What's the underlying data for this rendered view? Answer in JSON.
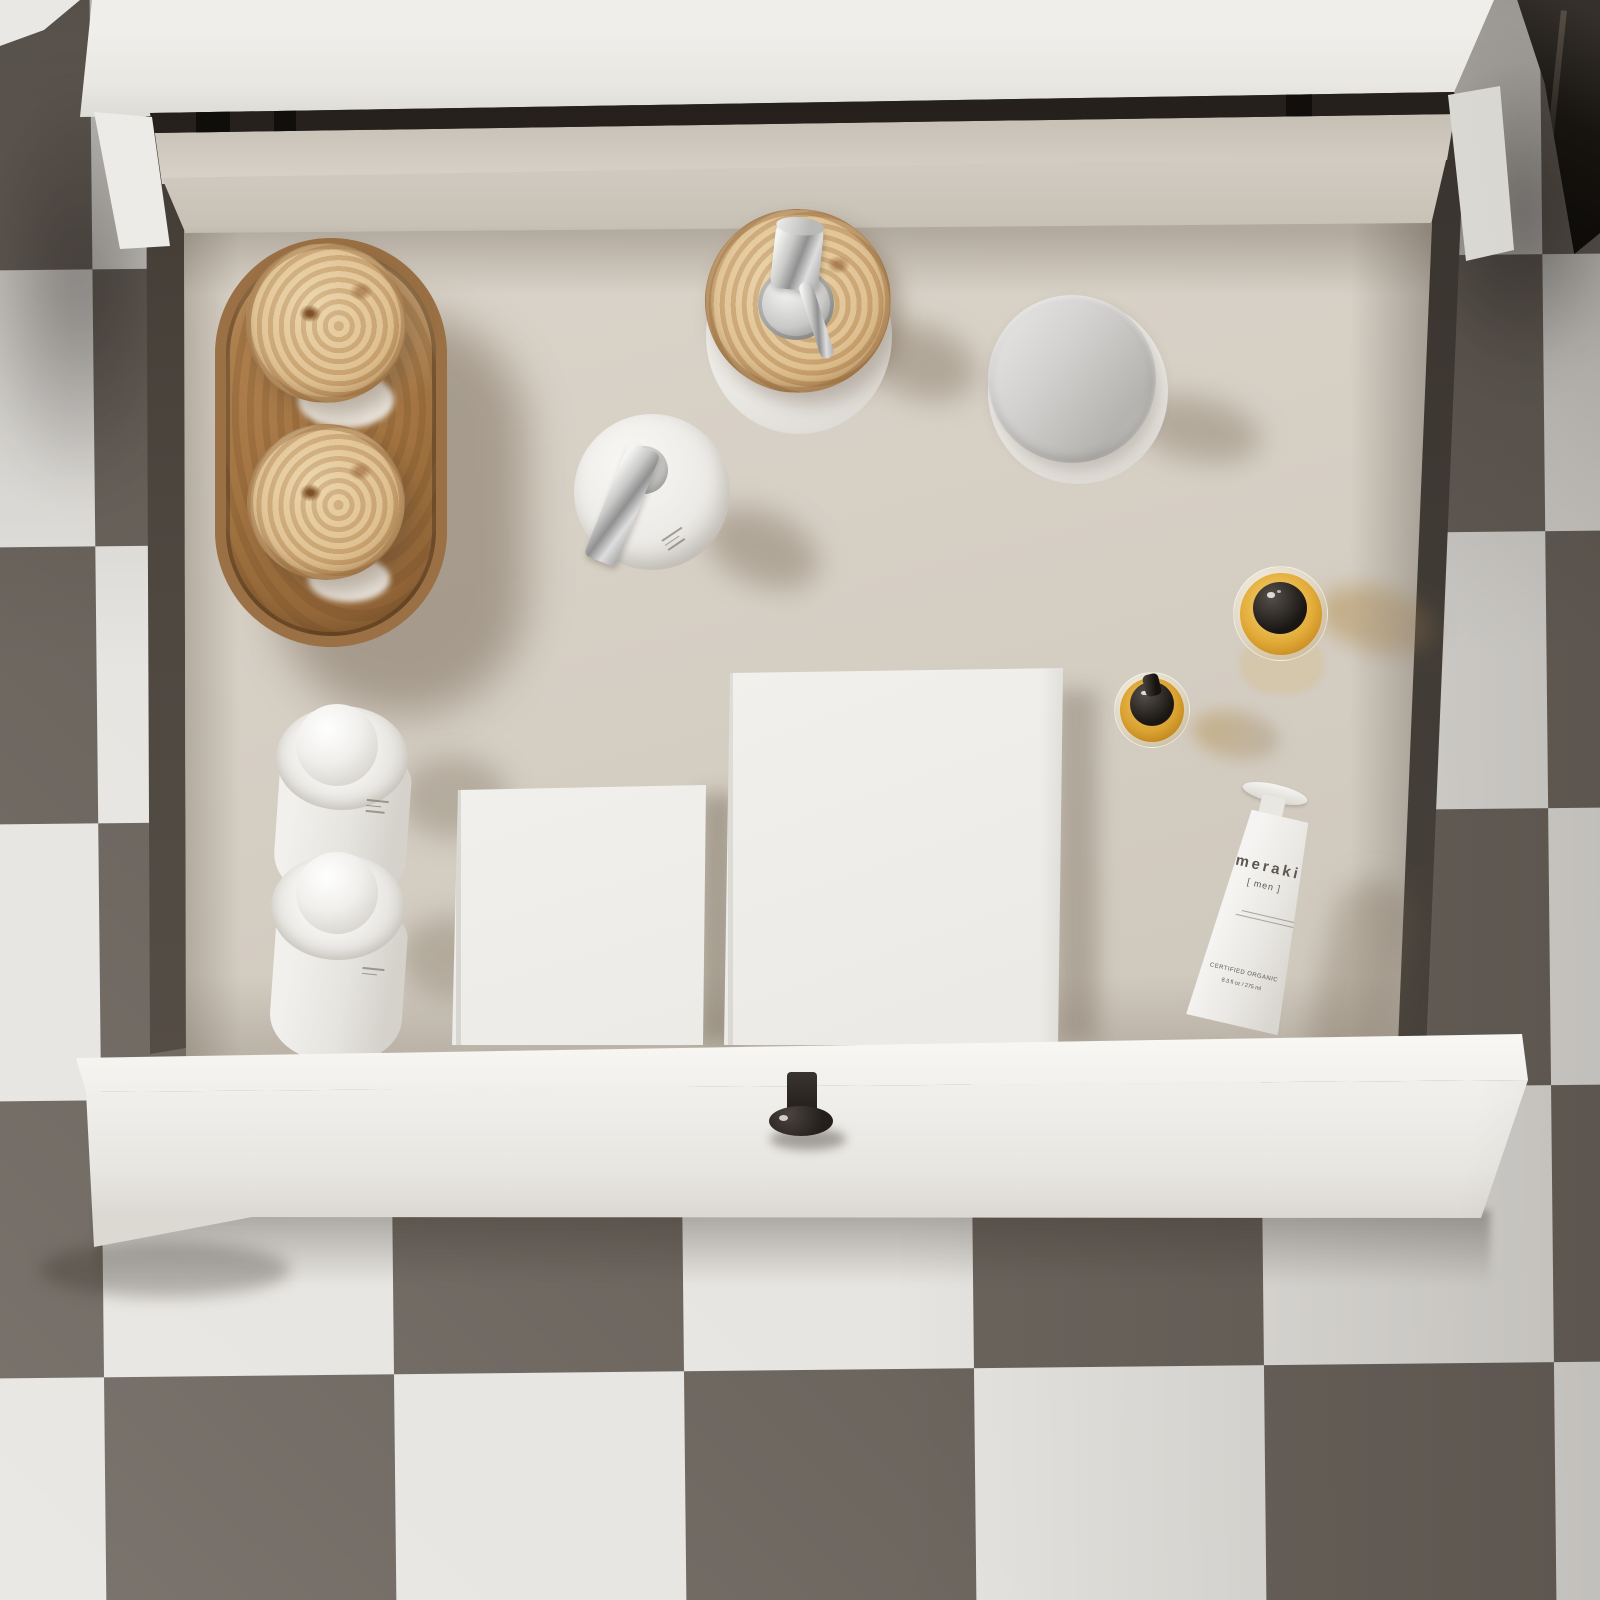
{
  "scene": {
    "title": "Top-down view of an open white vanity drawer with grooming products",
    "environment": {
      "floor": "checkerboard tile floor",
      "furniture": "white floating bathroom vanity with fully opened drawer"
    }
  },
  "palette": {
    "tile_light": "#e7e5e1",
    "tile_dark": "#6b645d",
    "cabinet_white": "#edece8",
    "drawer_interior_beige": "#d4cdc2",
    "drawer_wall_dark": "#46403a",
    "burl_wood": "#c49d66",
    "chrome": "#c9c9c8",
    "amber_glass": "#e2ab38",
    "knob_black": "#241f1c"
  },
  "items": [
    "wooden-oval-tray",
    "burl-lid-canister-1",
    "burl-lid-canister-2",
    "burl-lid-pump-jar",
    "white-pump-dispenser",
    "silver-lid-jar",
    "amber-glass-bottle-large",
    "amber-dropper-bottle-small",
    "white-ball-cap-bottle-1",
    "white-ball-cap-bottle-2",
    "white-box-small",
    "white-box-large",
    "meraki-mens-tube",
    "black-drawer-knob"
  ],
  "products": {
    "meraki_tube": {
      "brand": "meraki",
      "line": "[ men ]",
      "certified": "CERTIFIED ORGANIC",
      "volume": "8.3 fl oz / 275 ml"
    }
  }
}
